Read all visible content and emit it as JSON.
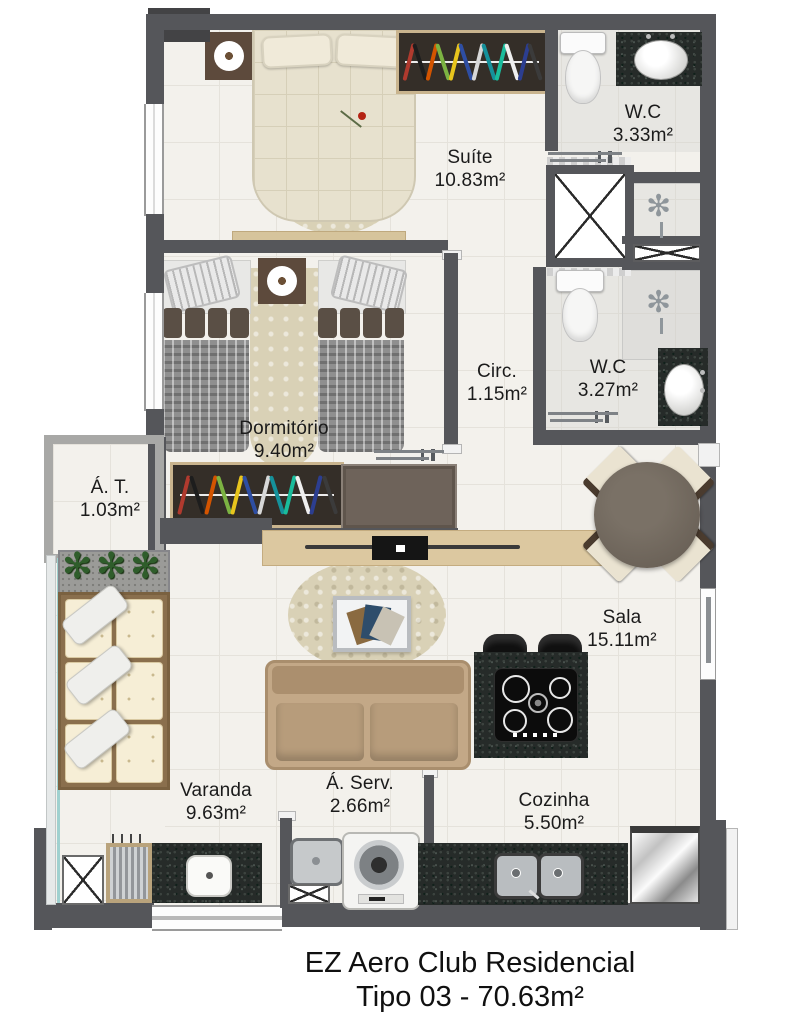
{
  "title": {
    "line1": "EZ Aero Club Residencial",
    "line2": "Tipo 03 - 70.63m²"
  },
  "rooms": [
    {
      "id": "suite",
      "name": "Suíte",
      "area": "10.83m²"
    },
    {
      "id": "wc-suite",
      "name": "W.C",
      "area": "3.33m²"
    },
    {
      "id": "circulacao",
      "name": "Circ.",
      "area": "1.15m²"
    },
    {
      "id": "wc-social",
      "name": "W.C",
      "area": "3.27m²"
    },
    {
      "id": "dormitorio",
      "name": "Dormitório",
      "area": "9.40m²"
    },
    {
      "id": "area-tecnica",
      "name": "Á. T.",
      "area": "1.03m²"
    },
    {
      "id": "sala",
      "name": "Sala",
      "area": "15.11m²"
    },
    {
      "id": "varanda",
      "name": "Varanda",
      "area": "9.63m²"
    },
    {
      "id": "area-servico",
      "name": "Á. Serv.",
      "area": "2.66m²"
    },
    {
      "id": "cozinha",
      "name": "Cozinha",
      "area": "5.50m²"
    }
  ],
  "icons": {
    "plant": "✻",
    "shower": "✻"
  },
  "colors": {
    "wall": "#55565a",
    "wall_dark": "#434345",
    "wall_light": "#a8a8a6",
    "floor": "#f3f1ec",
    "tile_line": "#e5e2db",
    "granite": "#262b29",
    "wood_light": "#dcc8a0",
    "wood_dark": "#4a4038",
    "bed_beige": "#e7e1ce",
    "glass_teal": "#9fd0cf",
    "plant_green": "#2f5d2b",
    "hangers": [
      "#b03a2e",
      "#1d1d1d",
      "#d35400",
      "#7cb342",
      "#e8c51d",
      "#2e4ea3",
      "#d8d8d8",
      "#15919b",
      "#1abc9c",
      "#efefef",
      "#2c3e90",
      "#3b3b3b"
    ]
  }
}
